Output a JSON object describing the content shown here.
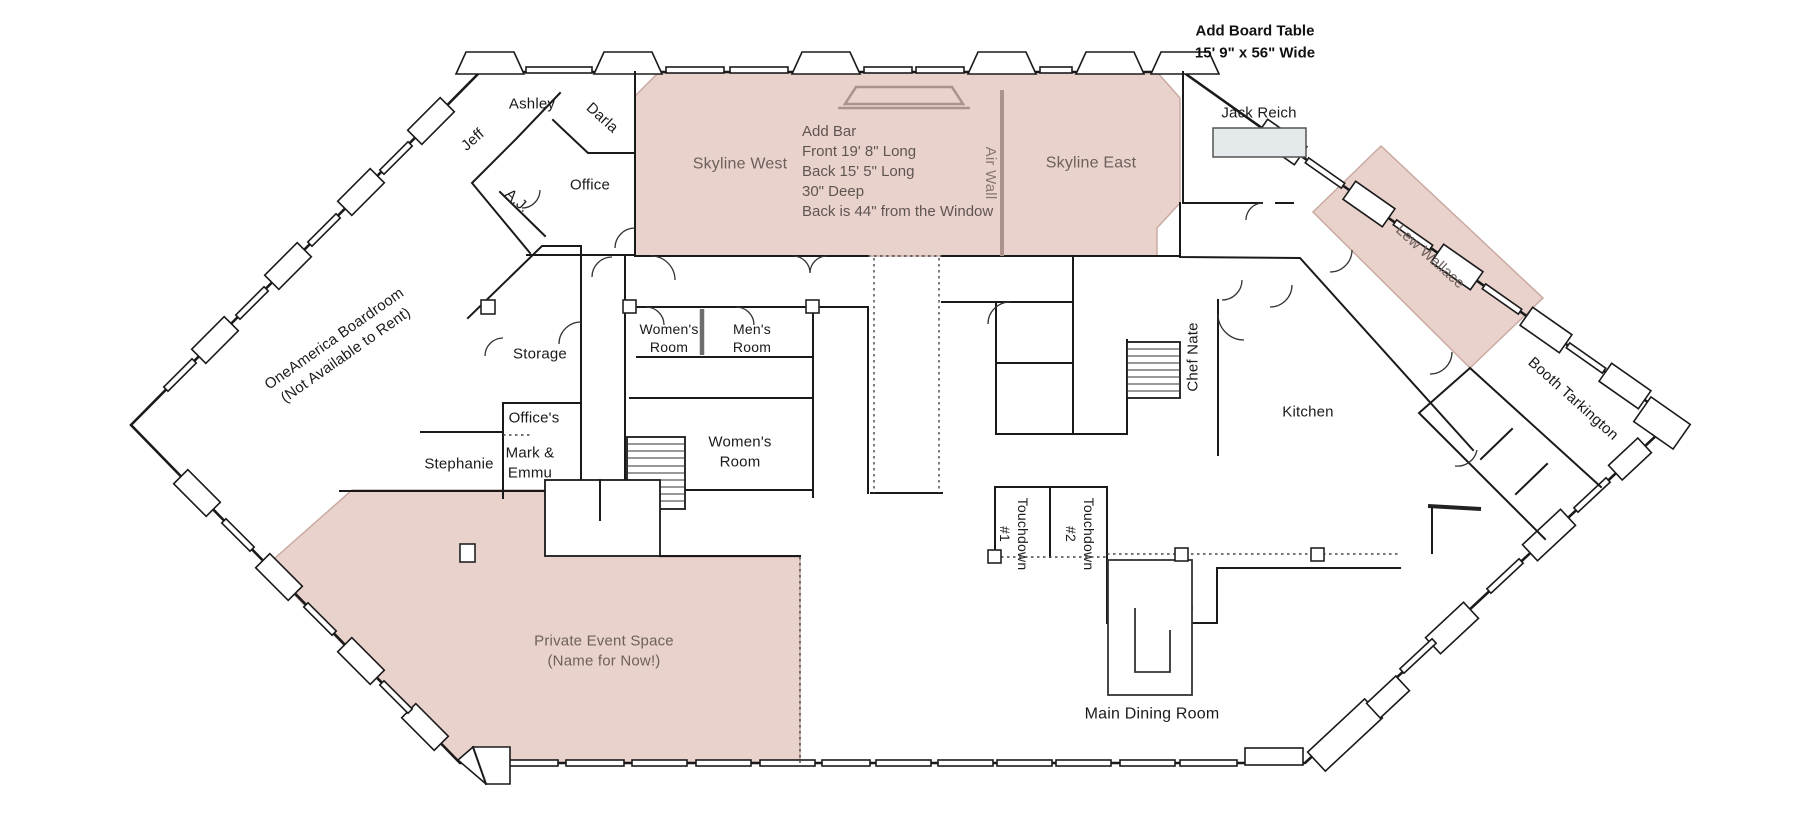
{
  "colors": {
    "pink_fill": "#e9d2cc",
    "pink_stroke": "#c9aaa2",
    "wall": "#1a1a1a",
    "accent_line": "#ab938c",
    "table_fill": "#e4e9ec",
    "label_muted": "#6d605b",
    "annotation": "#5f5550",
    "air_wall_label": "#8a7770"
  },
  "annotations": {
    "board_table": {
      "line1": "Add Board Table",
      "line2": "15' 9\" x 56\" Wide"
    },
    "add_bar": {
      "lines": [
        "Add Bar",
        "Front 19' 8\" Long",
        "Back 15' 5\" Long",
        "30\" Deep",
        "Back is 44\" from the Window"
      ]
    },
    "air_wall": {
      "label": "Air Wall"
    }
  },
  "rooms": {
    "ashley": {
      "label": "Ashley"
    },
    "darla": {
      "label": "Darla"
    },
    "jeff": {
      "label": "Jeff"
    },
    "aj": {
      "label": "A.J."
    },
    "office": {
      "label": "Office"
    },
    "skyline_west": {
      "label": "Skyline West"
    },
    "skyline_east": {
      "label": "Skyline East"
    },
    "jack_reich": {
      "label": "Jack Reich"
    },
    "lew_wallace": {
      "label": "Lew Wallace"
    },
    "booth_tarkington": {
      "label": "Booth Tarkington"
    },
    "oneamerica_boardroom": {
      "line1": "OneAmerica Boardroom",
      "line2": "(Not Available to Rent)"
    },
    "storage": {
      "label": "Storage"
    },
    "offices": {
      "label": "Office's"
    },
    "stephanie": {
      "label": "Stephanie"
    },
    "mark_emmu": {
      "line1": "Mark &",
      "line2": "Emmu"
    },
    "womens_room_upper": {
      "line1": "Women's",
      "line2": "Room"
    },
    "mens_room": {
      "line1": "Men's",
      "line2": "Room"
    },
    "womens_room_lower": {
      "line1": "Women's",
      "line2": "Room"
    },
    "chef_nate": {
      "label": "Chef Nate"
    },
    "kitchen": {
      "label": "Kitchen"
    },
    "touchdown_1": {
      "line1": "Touchdown",
      "line2": "#1"
    },
    "touchdown_2": {
      "line1": "Touchdown",
      "line2": "#2"
    },
    "main_dining_room": {
      "label": "Main Dining Room"
    },
    "private_event_space": {
      "line1": "Private Event Space",
      "line2": "(Name for Now!)"
    }
  }
}
